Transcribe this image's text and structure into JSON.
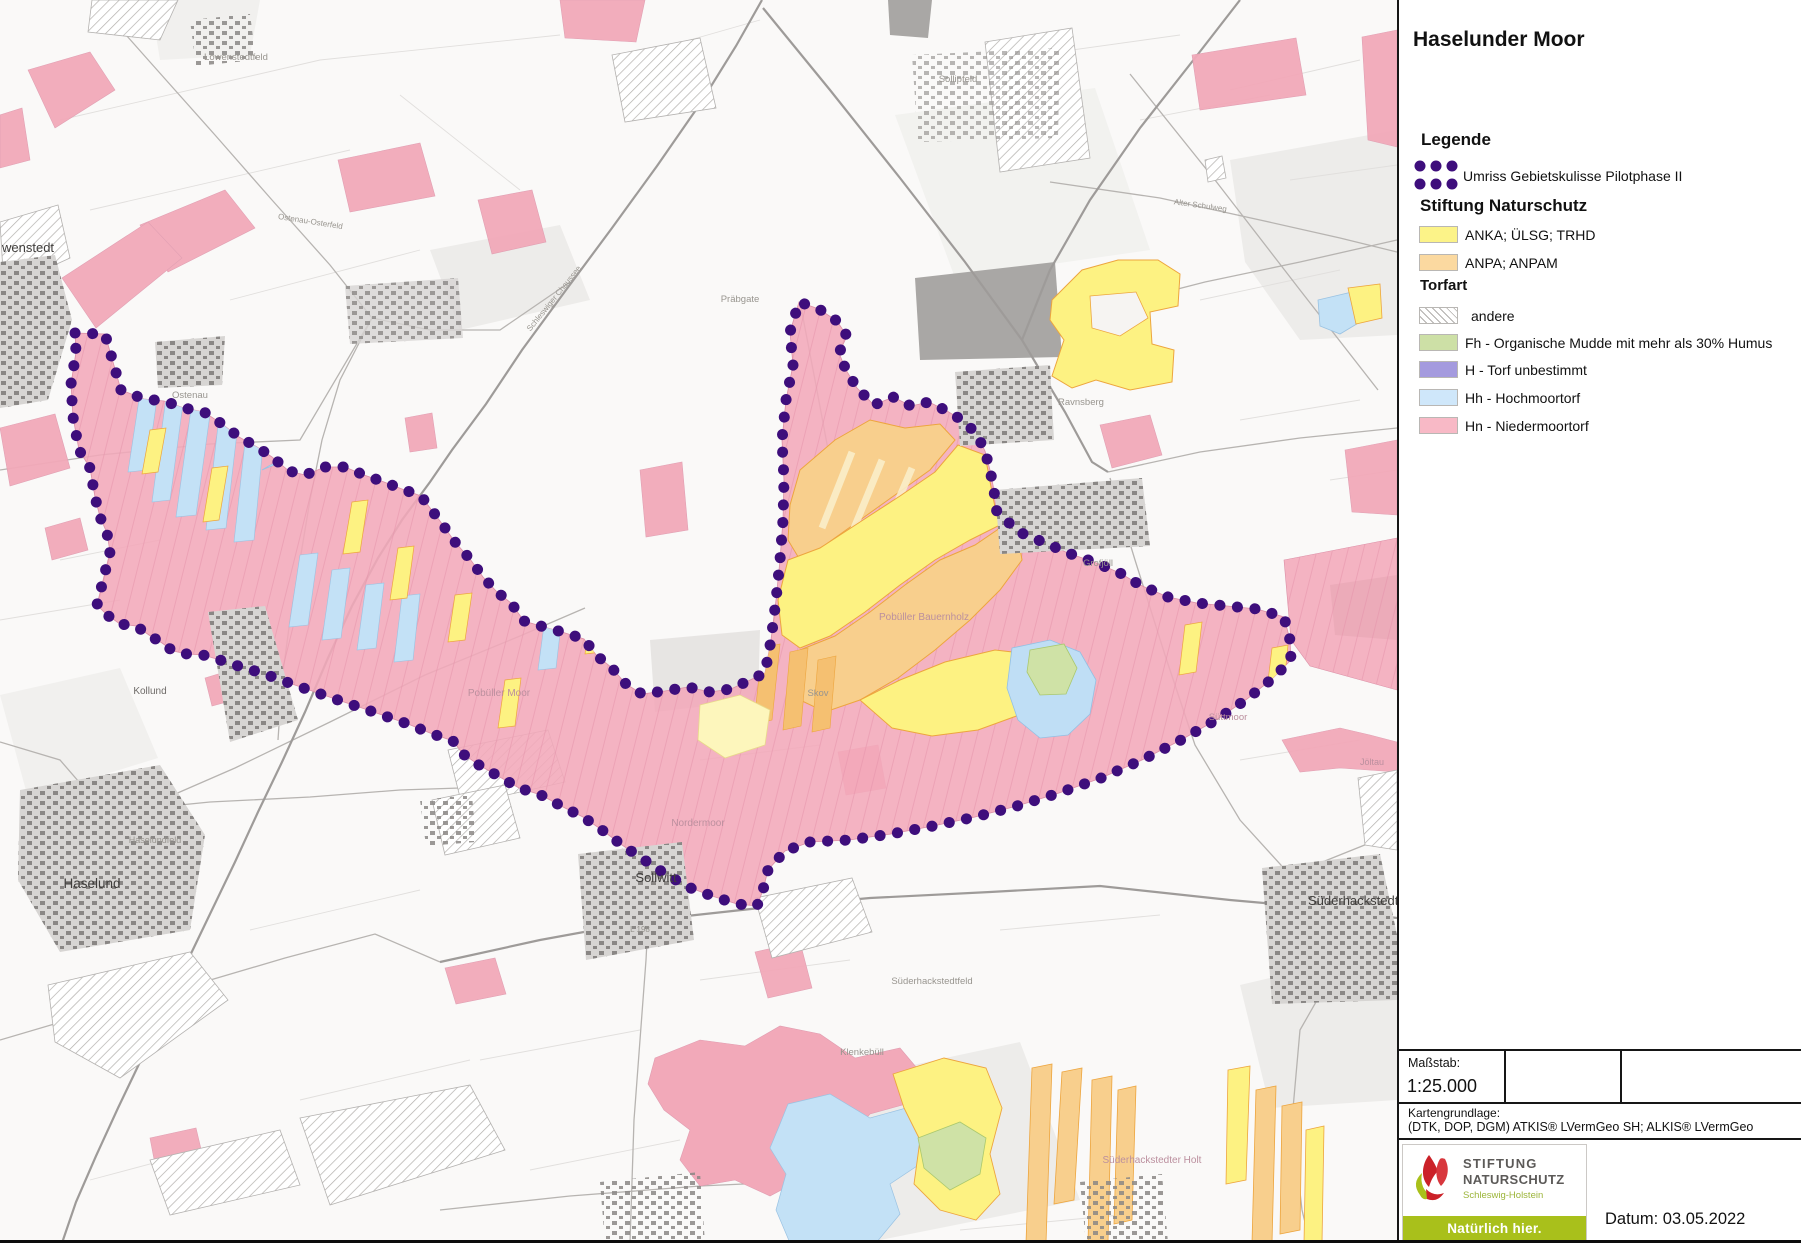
{
  "panel": {
    "title": "Haselunder Moor",
    "legend": {
      "heading": "Legende",
      "outline_label": "Umriss Gebietskulisse Pilotphase II",
      "outline_dot_color": "#3e0e7c",
      "stiftung_heading": "Stiftung Naturschutz",
      "stiftung_items": [
        {
          "label": "ANKA; ÜLSG; TRHD",
          "color": "#fcf388"
        },
        {
          "label": "ANPA; ANPAM",
          "color": "#fbd9a0"
        }
      ],
      "torfart_heading": "Torfart",
      "torfart_items": [
        {
          "label": "andere",
          "style": "hatch"
        },
        {
          "label": "Fh - Organische Mudde mit mehr als 30% Humus",
          "color": "#cde0a6"
        },
        {
          "label": "H - Torf unbestimmt",
          "color": "#a49ade"
        },
        {
          "label": "Hh - Hochmoortorf",
          "color": "#cfe7fa"
        },
        {
          "label": "Hn - Niedermoortorf",
          "color": "#f8b9c6"
        }
      ]
    },
    "scale": {
      "label": "Maßstab:",
      "value": "1:25.000"
    },
    "basemap": {
      "label": "Kartengrundlage:",
      "value": "(DTK, DOP, DGM) ATKIS® LVermGeo SH; ALKIS® LVermGeo"
    },
    "logo": {
      "line1": "STIFTUNG",
      "line2": "NATURSCHUTZ",
      "line3": "Schleswig-Holstein",
      "banner": "Natürlich hier."
    },
    "date_label": "Datum: 03.05.2022"
  },
  "map": {
    "colors": {
      "boundary_dots": "#3e0e7c",
      "niedermoortorf_pink": "#f2a9b9",
      "hochmoortorf_blue": "#c3e1f6",
      "anka_yellow": "#fdf282",
      "anpa_orange": "#f8cf8d",
      "fh_green": "#cfe2a6",
      "roads_gray": "#9e9b99",
      "buildings_gray": "#8a8785"
    },
    "labels": [
      {
        "t": "wenstedt",
        "x": 2,
        "y": 252,
        "s": 13,
        "c": "#3f3d3b",
        "a": "start"
      },
      {
        "t": "Löwenstedtfeld",
        "x": 236,
        "y": 60,
        "s": 9.5,
        "c": "#98958f",
        "a": "middle"
      },
      {
        "t": "Ostenau",
        "x": 190,
        "y": 398,
        "s": 9.5,
        "c": "#98958f",
        "a": "middle"
      },
      {
        "t": "Präbgate",
        "x": 740,
        "y": 302,
        "s": 9.5,
        "c": "#98958f",
        "a": "middle"
      },
      {
        "t": "Sollipfeld",
        "x": 958,
        "y": 82,
        "s": 9.5,
        "c": "#98958f",
        "a": "middle"
      },
      {
        "t": "Ravnsberg",
        "x": 1058,
        "y": 405,
        "s": 9.5,
        "c": "#98958f",
        "a": "start"
      },
      {
        "t": "Grofjöll",
        "x": 1098,
        "y": 566,
        "s": 9.5,
        "c": "#98958f",
        "a": "middle"
      },
      {
        "t": "Kollund",
        "x": 150,
        "y": 694,
        "s": 10,
        "c": "#6e6b68",
        "a": "middle"
      },
      {
        "t": "Haselund",
        "x": 92,
        "y": 888,
        "s": 13.5,
        "c": "#3f3d3b",
        "a": "middle"
      },
      {
        "t": "Pobüller Moor",
        "x": 499,
        "y": 696,
        "s": 10,
        "c": "#bb8f9e",
        "a": "middle"
      },
      {
        "t": "Nordermoor",
        "x": 698,
        "y": 826,
        "s": 10,
        "c": "#bb8f9e",
        "a": "middle"
      },
      {
        "t": "Pobüller Bauernholz",
        "x": 924,
        "y": 620,
        "s": 10,
        "c": "#bb8f9e",
        "a": "middle"
      },
      {
        "t": "Skov",
        "x": 818,
        "y": 696,
        "s": 9.5,
        "c": "#98958f",
        "a": "middle"
      },
      {
        "t": "Süttmoor",
        "x": 1228,
        "y": 720,
        "s": 9.5,
        "c": "#bb8f9e",
        "a": "middle"
      },
      {
        "t": "Sollwitt",
        "x": 656,
        "y": 882,
        "s": 13,
        "c": "#3f3d3b",
        "a": "middle"
      },
      {
        "t": "Süderhackstedt",
        "x": 1308,
        "y": 905,
        "s": 13,
        "c": "#3f3d3b",
        "a": "start"
      },
      {
        "t": "Süderhackstedtfeld",
        "x": 932,
        "y": 984,
        "s": 9.5,
        "c": "#98958f",
        "a": "middle"
      },
      {
        "t": "Klenkebüll",
        "x": 862,
        "y": 1055,
        "s": 9.5,
        "c": "#98958f",
        "a": "middle"
      },
      {
        "t": "Süderhackstedter Holt",
        "x": 1152,
        "y": 1163,
        "s": 10,
        "c": "#bb8f9e",
        "a": "middle"
      },
      {
        "t": "Jöltau",
        "x": 1372,
        "y": 765,
        "s": 9,
        "c": "#bb8f9e",
        "a": "middle"
      },
      {
        "t": "Haselundfeld",
        "x": 155,
        "y": 843,
        "s": 9,
        "c": "#98958f",
        "a": "middle"
      },
      {
        "t": "Schleswiger Chaussee",
        "x": 556,
        "y": 300,
        "s": 8,
        "c": "#98958f",
        "a": "middle",
        "r": -51
      },
      {
        "t": "Ostenau-Osterfeld",
        "x": 310,
        "y": 224,
        "s": 8,
        "c": "#98958f",
        "a": "middle",
        "r": 9
      },
      {
        "t": "Alter Schulweg",
        "x": 1200,
        "y": 208,
        "s": 8,
        "c": "#98958f",
        "a": "middle",
        "r": 8
      },
      {
        "t": "L 198",
        "x": 640,
        "y": 932,
        "s": 8,
        "c": "#98958f",
        "a": "middle"
      }
    ]
  }
}
